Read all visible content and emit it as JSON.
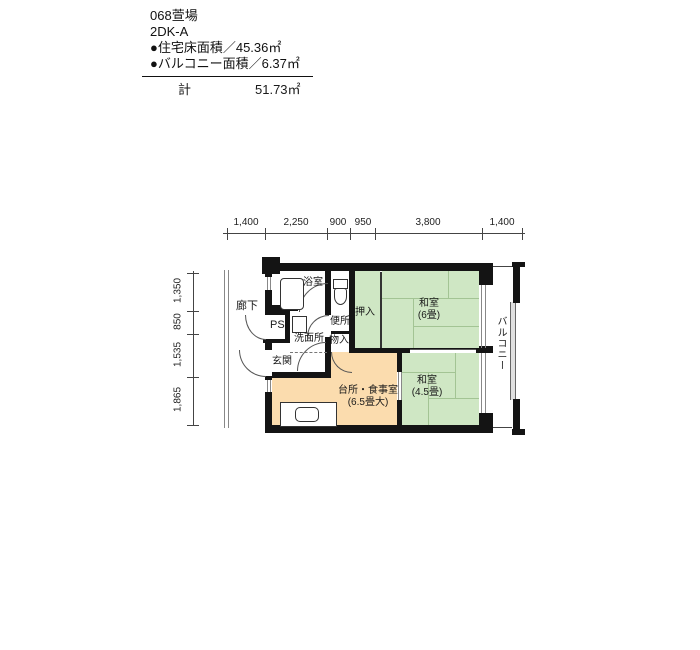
{
  "header": {
    "title": "068萱場",
    "plan_type": "2DK-A",
    "floor_area": "●住宅床面積／45.36㎡",
    "balcony_area": "●バルコニー面積／6.37㎡",
    "total_label": "計",
    "total_value": "51.73㎡"
  },
  "dimensions": {
    "top": [
      "1,400",
      "2,250",
      "900",
      "950",
      "3,800",
      "1,400"
    ],
    "left": [
      "1,350",
      "850",
      "1,535",
      "1,865"
    ]
  },
  "labels": {
    "corridor": "廊下",
    "bath": "浴室",
    "toilet": "便所",
    "pipe_shaft": "PS",
    "washroom": "洗面所",
    "entrance": "玄関",
    "closet": "押入",
    "storage": "物入",
    "balcony": "バルコニー",
    "washitsu_6": {
      "name": "和室",
      "size": "(6畳)"
    },
    "washitsu_45": {
      "name": "和室",
      "size": "(4.5畳)"
    },
    "kitchen": {
      "name": "台所・食事室",
      "size": "(6.5畳大)"
    }
  },
  "colors": {
    "tatami_room": "#cfe7c4",
    "kitchen_room": "#fbdcae",
    "wall": "#141414"
  }
}
